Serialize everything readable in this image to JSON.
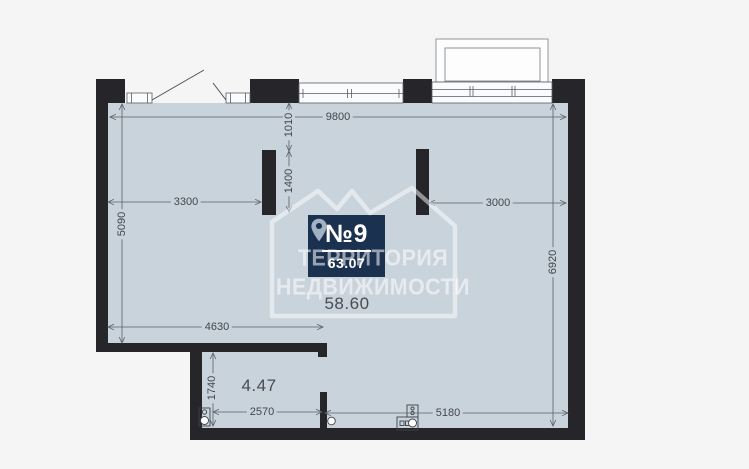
{
  "page": {
    "background": "#f5f5f6"
  },
  "plan": {
    "unit": {
      "number": "№9",
      "total_area": "63.07"
    },
    "rooms": [
      {
        "name": "main-room",
        "area": "58.60"
      },
      {
        "name": "small-room",
        "area": "4.47"
      }
    ],
    "dimensions_mm": {
      "top_total": "9800",
      "top_offset": "1010",
      "pilaster_span": "1400",
      "left_to_pilaster": "3300",
      "pilaster_to_right": "3000",
      "left_height": "5090",
      "right_height": "6920",
      "bottom_left_width": "4630",
      "small_room_height": "1740",
      "small_room_width": "2570",
      "bottom_right_width": "5180"
    },
    "watermark": {
      "line1": "ТЕРРИТОРИЯ",
      "line2": "НЕДВИЖИМОСТИ"
    },
    "colors": {
      "floor": "#c9d3dc",
      "wall": "#26262a",
      "badge_background": "#1b3150",
      "badge_text": "#ffffff",
      "dimension_text": "#42464b",
      "watermark": "#ffffff",
      "pin": "#a3b2c2"
    }
  }
}
